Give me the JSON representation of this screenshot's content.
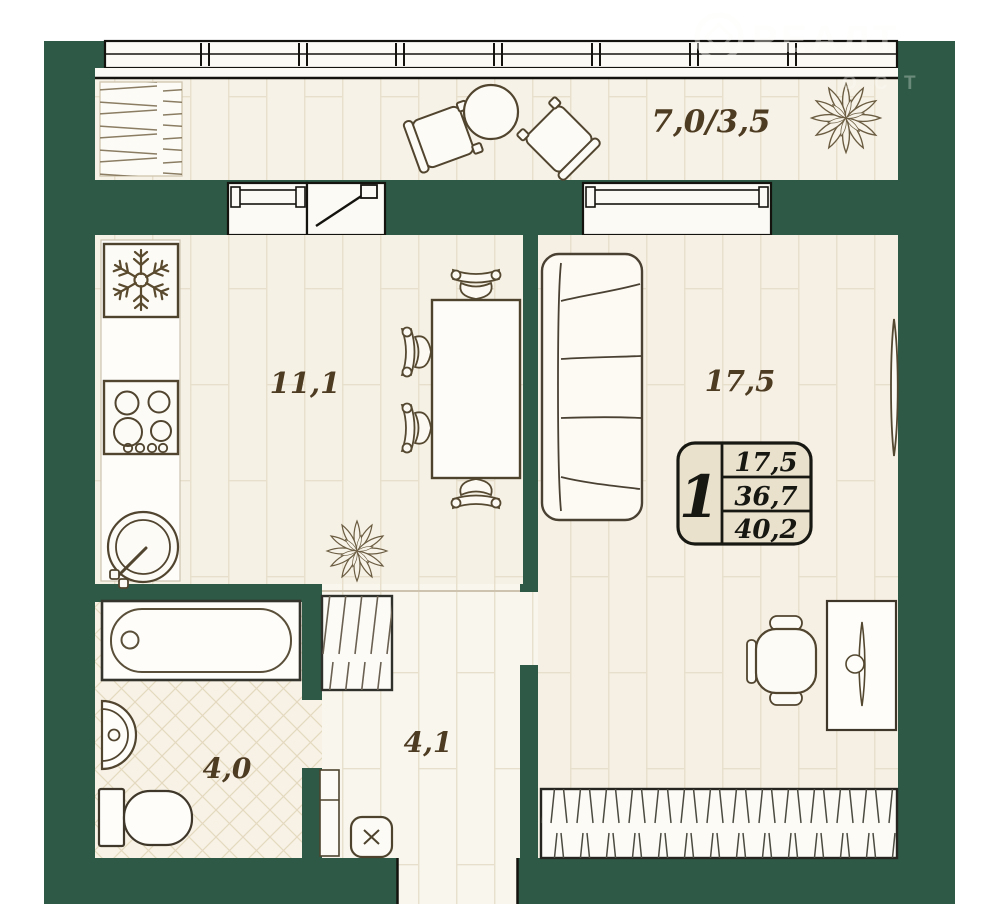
{
  "plan": {
    "watermark": {
      "line1": "РЕАЛТ",
      "line2": "ОСТ"
    },
    "rooms": {
      "balcony": {
        "label": "7,0/3,5"
      },
      "kitchen": {
        "label": "11,1"
      },
      "living": {
        "label": "17,5"
      },
      "hallway": {
        "label": "4,1"
      },
      "bathroom": {
        "label": "4,0"
      }
    },
    "info_box": {
      "rooms_count": "1",
      "living_area": "17,5",
      "usable_area": "36,7",
      "total_area": "40,2"
    },
    "colors": {
      "wall_green": "#2d5946",
      "floor_cream": "#f6f1e5",
      "furniture_outline": "#51452f",
      "label_text": "#4d3b22",
      "info_box_bg": "#eae1cd"
    }
  }
}
